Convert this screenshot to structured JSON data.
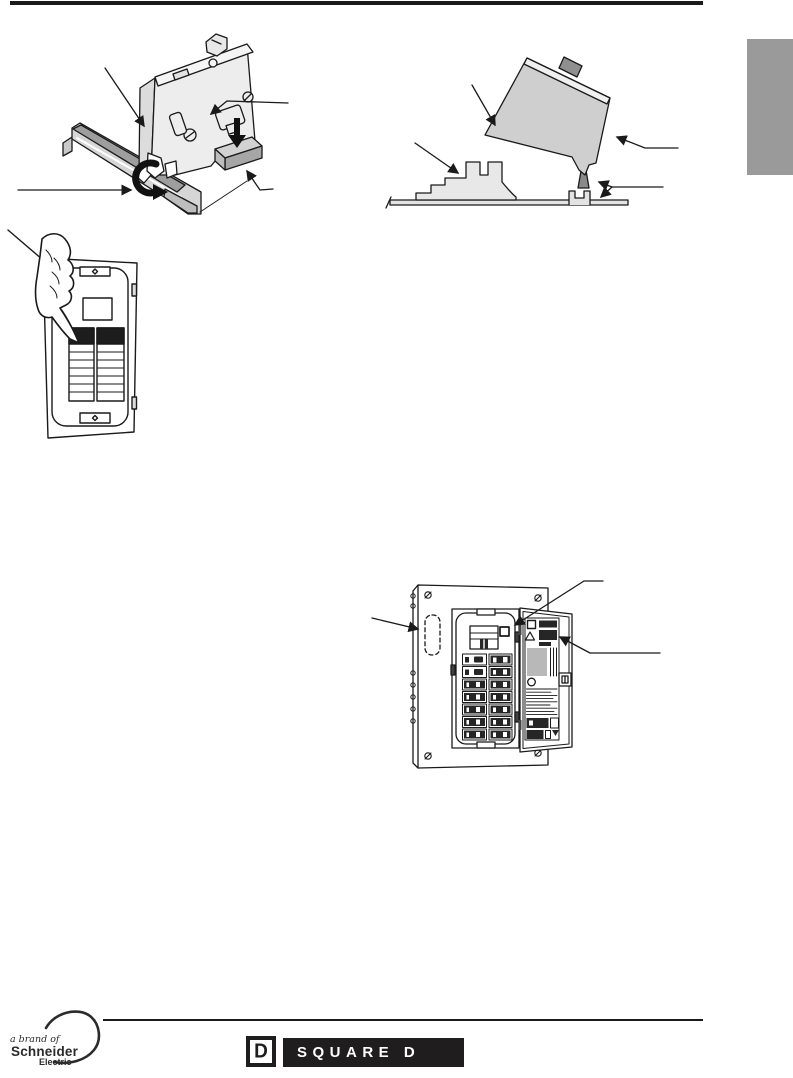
{
  "page": {
    "background": "#ffffff"
  },
  "decor": {
    "top_rule_color": "#1a1a1a",
    "footer_rule_color": "#1a1a1a",
    "side_tab_color": "#9a9a9a",
    "line_art_ink": "#1a1a1a",
    "logo_bar_color": "#201d1e"
  },
  "footer": {
    "schneider": {
      "tagline": "a brand of",
      "brand": "Schneider",
      "sub_brand": "Electric"
    },
    "square_d": {
      "emblem_letter": "D",
      "wordmark": "SQUARE D"
    }
  }
}
